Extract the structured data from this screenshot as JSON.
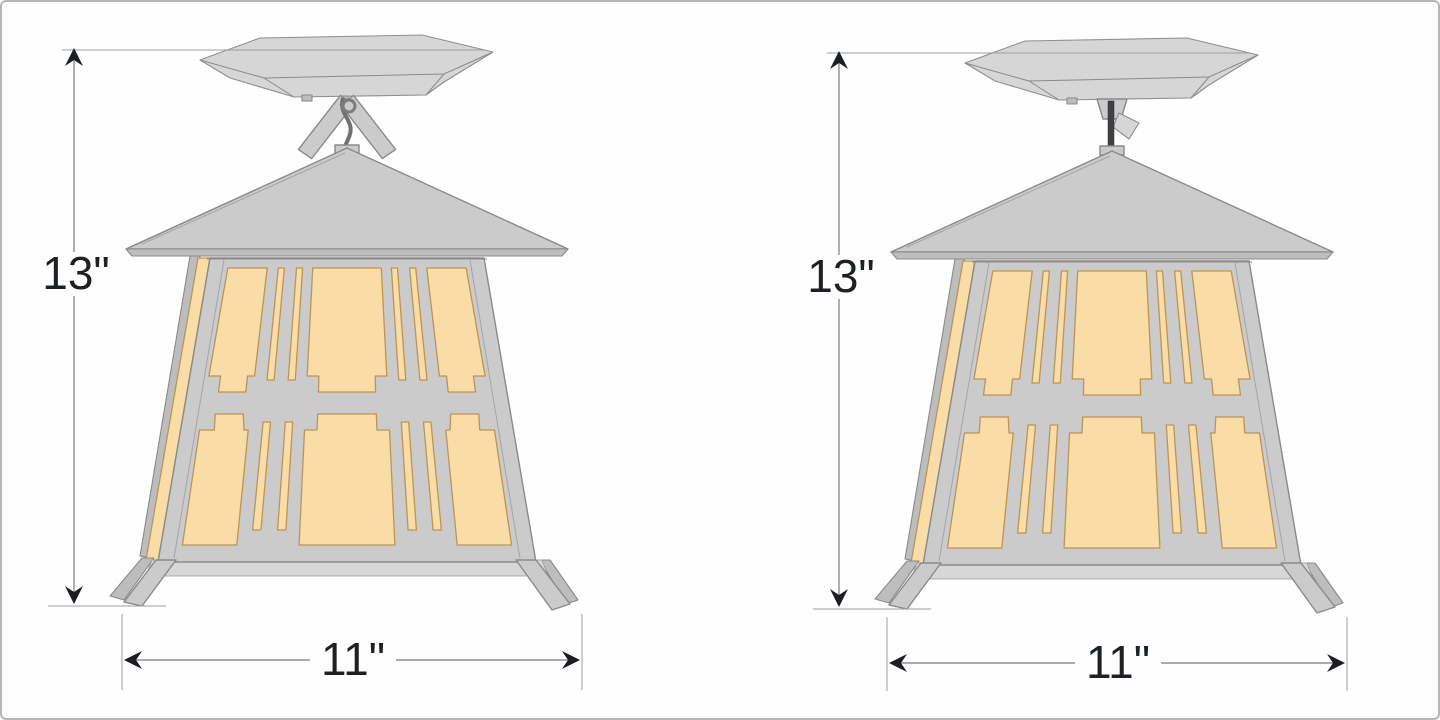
{
  "page": {
    "background": "#fefefe",
    "border_color": "#b6b6b6",
    "description_of_content": "two dimensioned product drawings of a craftsman-style ceiling lantern"
  },
  "figures": [
    {
      "name": "lantern-with-swivel-mount",
      "mount": "swivel",
      "height_label": "13\"",
      "width_label": "11\""
    },
    {
      "name": "lantern-with-stem-mount",
      "mount": "stem",
      "height_label": "13\"",
      "width_label": "11\""
    }
  ],
  "dimensions": {
    "height_inches": 13,
    "width_inches": 11
  },
  "colors": {
    "metal": "#cbcbcb",
    "metal_outline": "#8a8a8a",
    "glass": "#f9dca6",
    "glass_outline": "#bd9454",
    "stem_rod": "#3f4245",
    "dimension_line": "#8b9094",
    "dimension_arrow": "#1c1f22",
    "dimension_text": "#1e2124"
  }
}
